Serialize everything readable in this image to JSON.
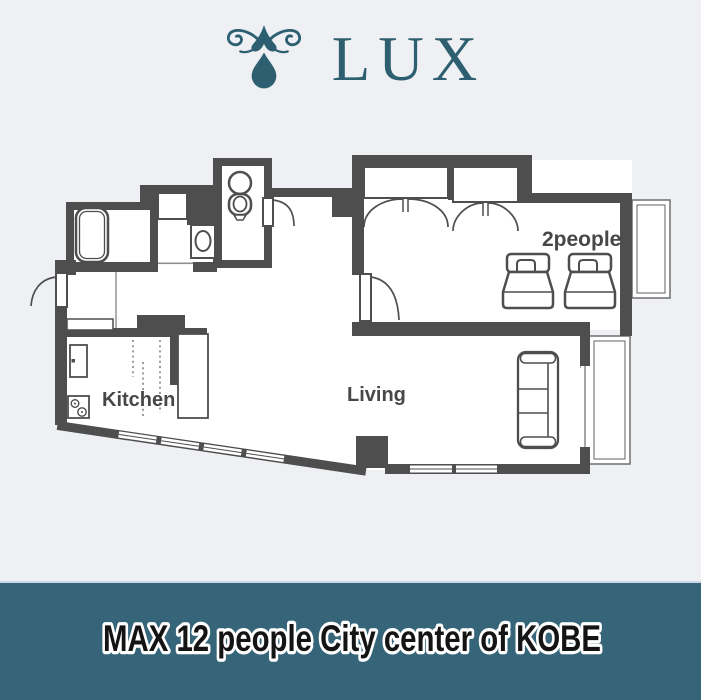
{
  "brand": {
    "name": "LUX",
    "ornament_icon": "water-drop-flourish",
    "color": "#2d5f70"
  },
  "banner": {
    "text": "MAX 12  people City center of KOBE",
    "bg_color": "#366579",
    "text_color": "#141414",
    "outline_color": "#ffffff"
  },
  "rooms": {
    "kitchen_label": "Kitchen",
    "living_label": "Living",
    "bedroom_capacity_label": "2people"
  },
  "fixtures": [
    "bathtub",
    "washing-machine",
    "washbasin",
    "toilet",
    "closet-bifold-doors",
    "single-bed",
    "single-bed",
    "sofa",
    "refrigerator",
    "gas-stove",
    "entrance-door",
    "toilet-door",
    "bedroom-door",
    "balcony",
    "balcony",
    "windows"
  ],
  "colors": {
    "wall": "#4e4e4e",
    "floor": "#ffffff",
    "background": "#eef0f3",
    "label": "#474747"
  }
}
